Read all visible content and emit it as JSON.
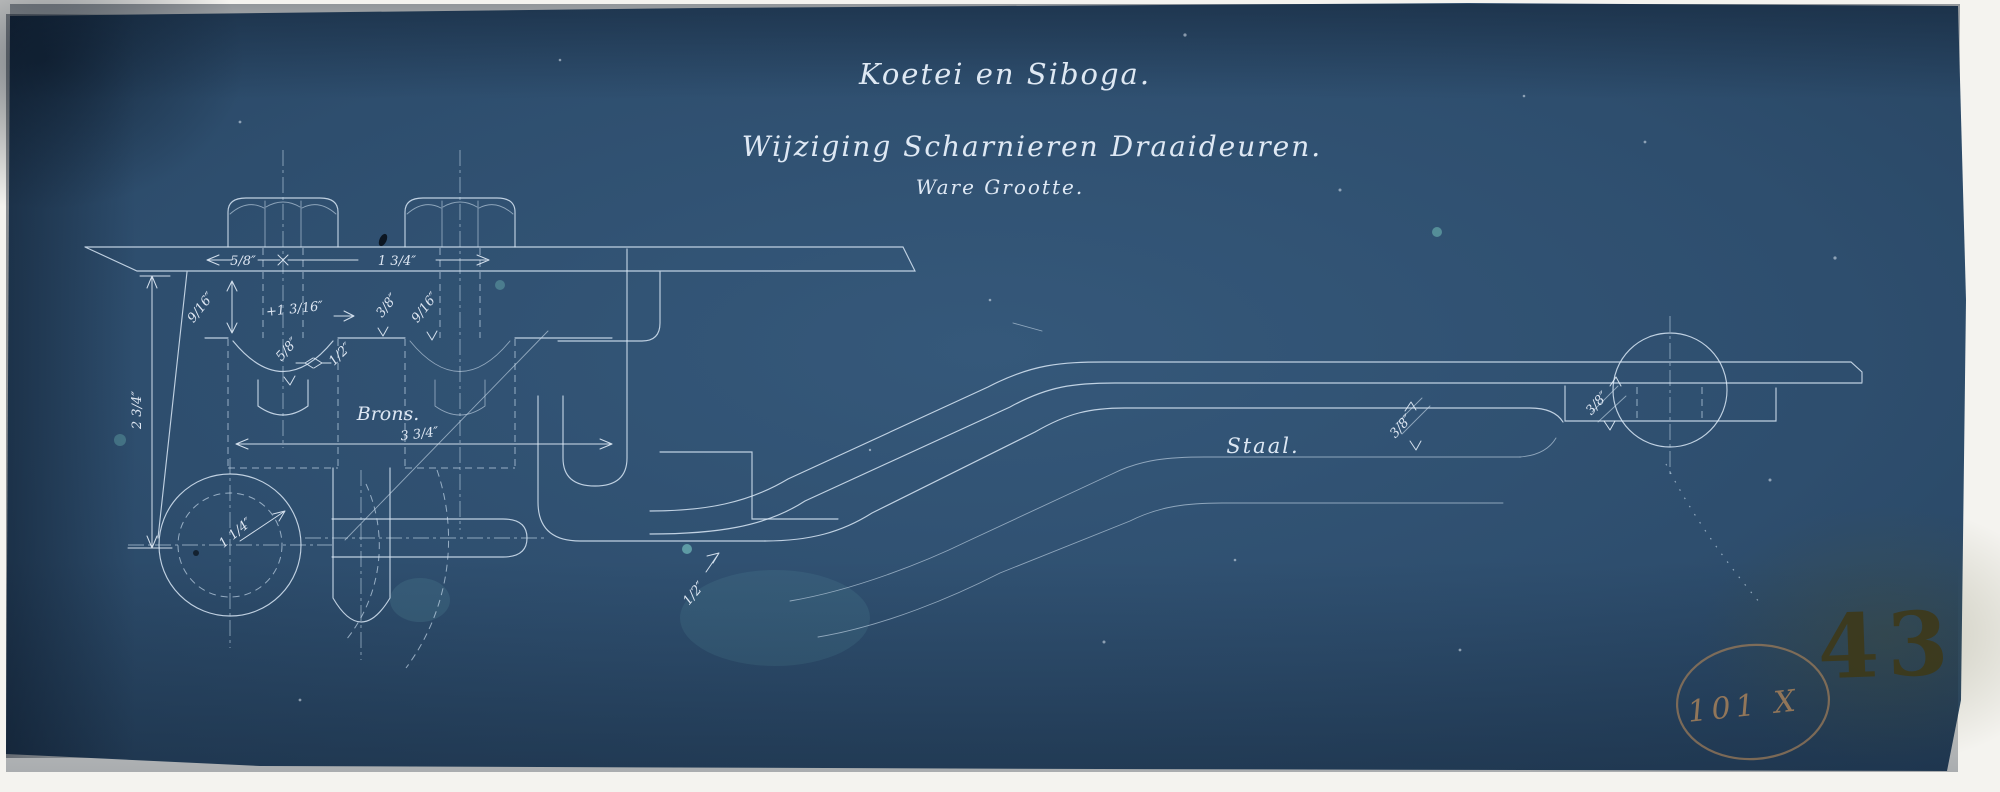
{
  "titles": {
    "line1": "Koetei en Siboga.",
    "line2": "Wijziging Scharnieren Draaideuren.",
    "line3": "Ware Grootte."
  },
  "materials": {
    "bronze": "Brons.",
    "steel": "Staal."
  },
  "dimensions": {
    "plate_edge_to_bolt": "5/8″",
    "bolt_spacing": "1 3/4″",
    "recess_depth": "9/16″",
    "bolt_projection": "+1 3/16″",
    "counterbore_a": "5/8″",
    "counterbore_b": "1/2″",
    "bolt2_a": "3/8″",
    "bolt2_b": "9/16″",
    "bracket_height": "2 3/4″",
    "pivot_to_hook": "3 3/4″",
    "pivot_radius": "1 1/4″",
    "hook_plate": "1/2″",
    "arm_thickness": "3/8″",
    "eye_plate": "3/8″"
  },
  "stamps": {
    "drawing_number": "43",
    "annotation": "101 X"
  },
  "colors": {
    "paper": "#f3f2ee",
    "blueprint_blue": "#2e4d6c",
    "line_white": "#dbe9f6",
    "stamp_olive": "#3e3918",
    "stamp_brown": "#9a7a58"
  }
}
